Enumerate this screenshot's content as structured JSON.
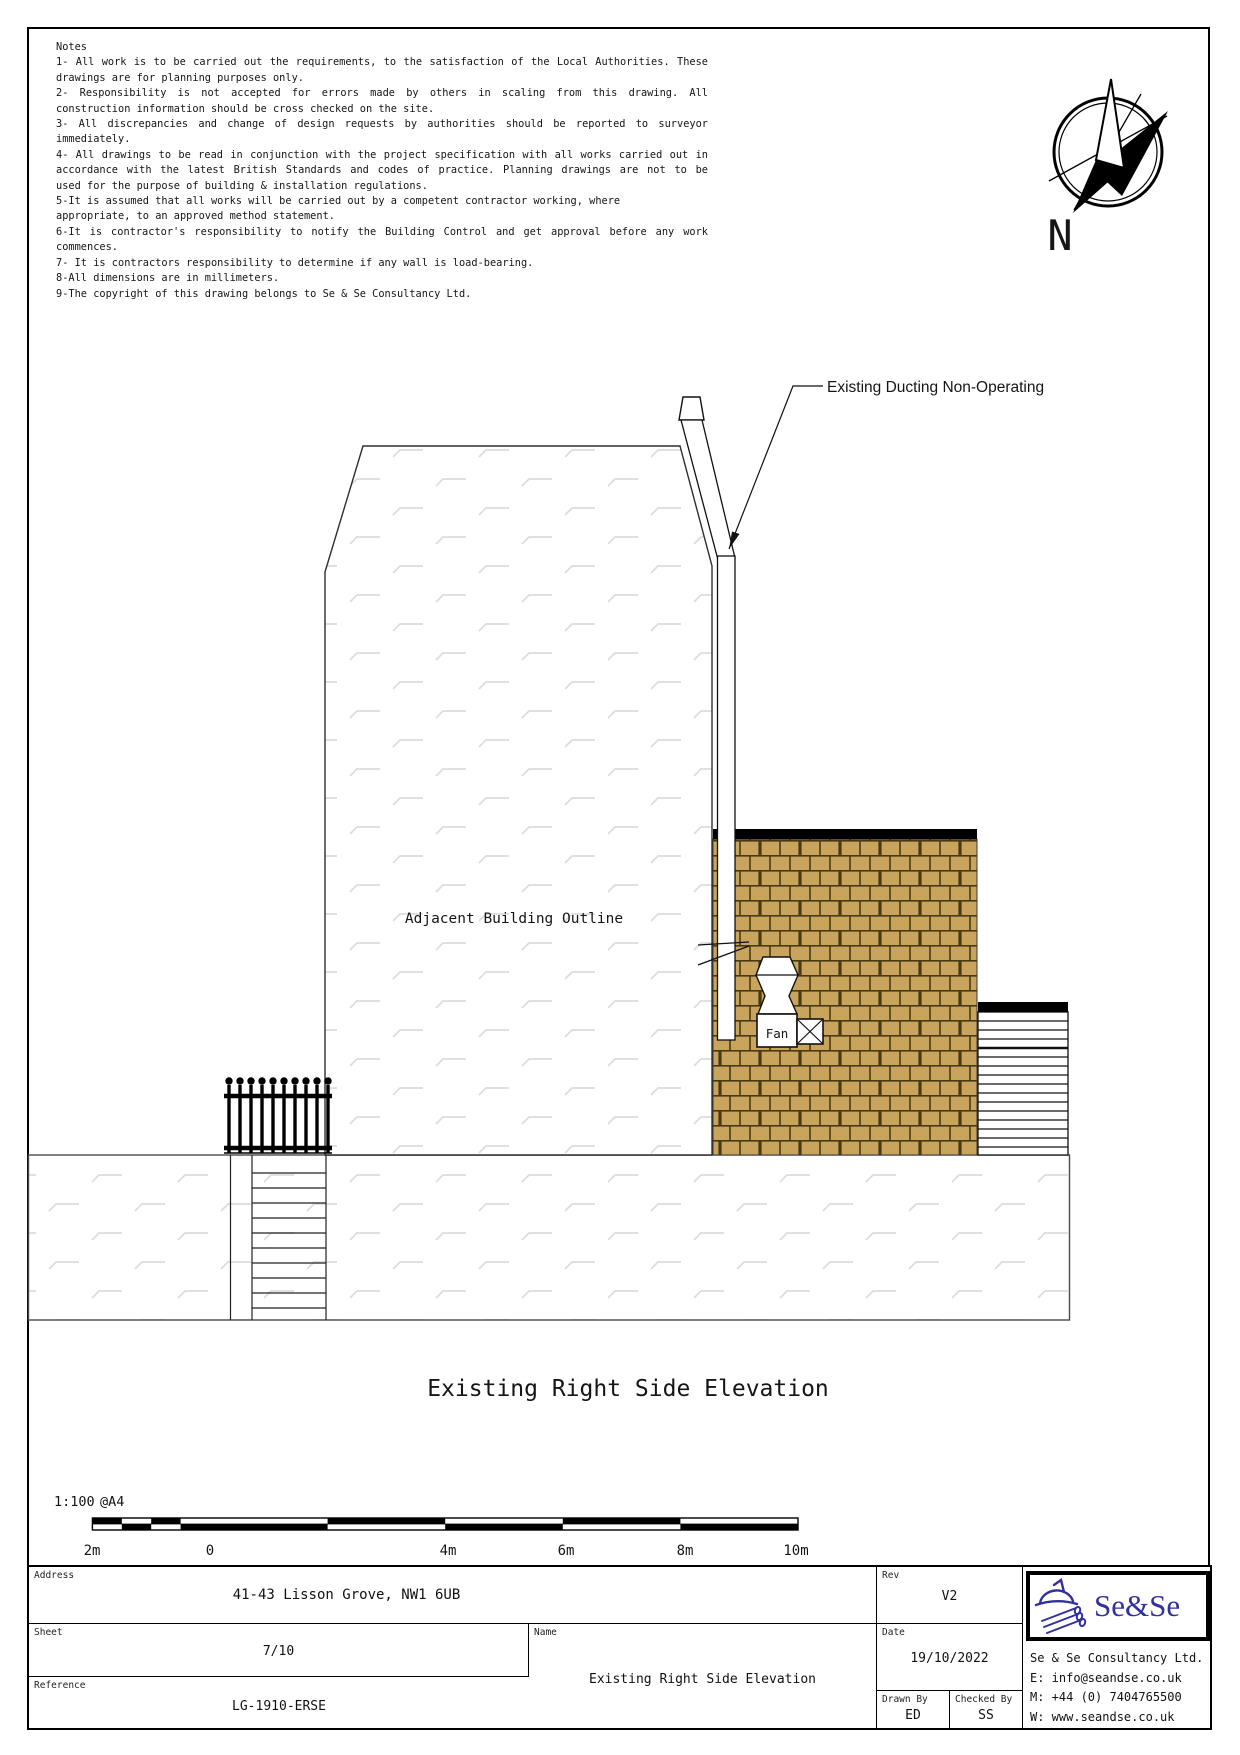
{
  "sheet_notes": {
    "heading": "Notes",
    "lines": [
      "1- All work is to be carried out the requirements, to the satisfaction of the Local Authorities. These",
      "drawings are for planning purposes only.",
      "2- Responsibility is not accepted for errors made by others in scaling from this drawing. All",
      "construction information should be cross checked on the site.",
      "3- All discrepancies and change of design requests by authorities should be reported to surveyor",
      "immediately.",
      "4- All drawings to be read in conjunction with the project specification with all works carried out in",
      "accordance with the latest British Standards and codes of practice. Planning drawings are not to be",
      "used for the purpose of building & installation regulations.",
      "5-It is assumed that all works will be carried out by a competent contractor working, where",
      "appropriate, to an approved method statement.",
      "6-It is contractor's responsibility to notify the Building Control and get approval before any work",
      "commences.",
      "7- It is contractors responsibility to determine if any wall is load-bearing.",
      "8-All dimensions are in millimeters.",
      "9-The copyright of this drawing belongs to Se & Se Consultancy Ltd."
    ]
  },
  "compass": {
    "label": "N"
  },
  "annotations": {
    "duct": "Existing Ducting Non-Operating",
    "adjacent": "Adjacent Building Outline",
    "fan": "Fan",
    "view_title": "Existing Right Side Elevation"
  },
  "scale_bar": {
    "ratio": "1:100",
    "paper": "@A4",
    "ticks": [
      "2m",
      "0",
      "4m",
      "6m",
      "8m",
      "10m"
    ]
  },
  "title_block": {
    "address": {
      "label": "Address",
      "value": "41-43 Lisson Grove, NW1 6UB"
    },
    "sheet": {
      "label": "Sheet",
      "value": "7/10"
    },
    "reference": {
      "label": "Reference",
      "value": "LG-1910-ERSE"
    },
    "name": {
      "label": "Name",
      "value": "Existing Right Side Elevation"
    },
    "rev": {
      "label": "Rev",
      "value": "V2"
    },
    "date": {
      "label": "Date",
      "value": "19/10/2022"
    },
    "drawn_by": {
      "label": "Drawn By",
      "value": "ED"
    },
    "checked_by": {
      "label": "Checked By",
      "value": "SS"
    },
    "logo_text": "Se&Se",
    "company": {
      "name": "Se & Se Consultancy Ltd.",
      "email": "E: info@seandse.co.uk",
      "mobile": "M: +44 (0) 7404765500",
      "web": "W: www.seandse.co.uk"
    }
  },
  "colors": {
    "brick": "#c8a45c",
    "mortar": "#4a3a14",
    "hatch": "#dcdcdc",
    "logo_navy": "#31319b",
    "band": "#000000"
  }
}
